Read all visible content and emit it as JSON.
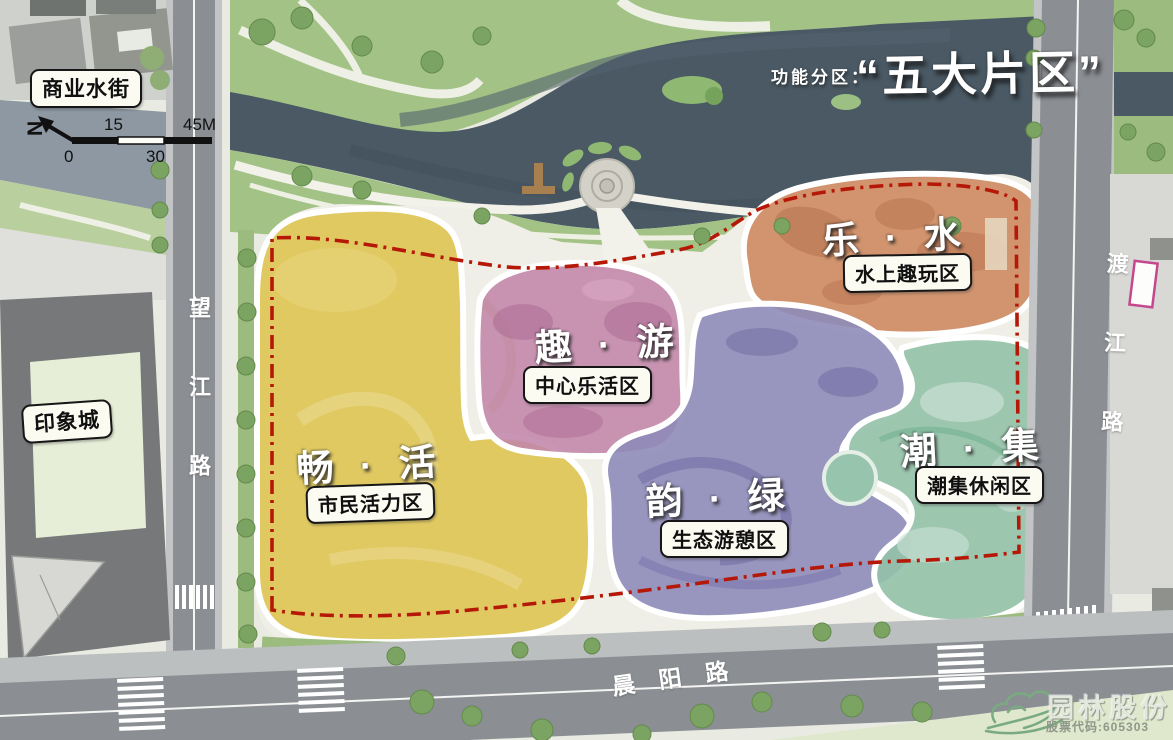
{
  "title": {
    "prefix": "功能分区：",
    "main": "“五大片区”"
  },
  "north": {
    "label": "N"
  },
  "scale_bar": {
    "tick_0": "0",
    "tick_15": "15",
    "tick_30": "30",
    "tick_45": "45M"
  },
  "zones": [
    {
      "name": "畅 · 活",
      "subtitle": "市民活力区",
      "color": "#ddc44e"
    },
    {
      "name": "趣 · 游",
      "subtitle": "中心乐活区",
      "color": "#c286aa"
    },
    {
      "name": "乐 · 水",
      "subtitle": "水上趣玩区",
      "color": "#cd8a62"
    },
    {
      "name": "韵 · 绿",
      "subtitle": "生态游憩区",
      "color": "#8e8bb9"
    },
    {
      "name": "潮 · 集",
      "subtitle": "潮集休闲区",
      "color": "#93c1a9"
    }
  ],
  "landmarks": {
    "water_street": "商业水街",
    "yinxiangcheng": "印象城"
  },
  "roads": {
    "west": "望江路",
    "east": "渡江路",
    "south": "晨阳路"
  },
  "logo": {
    "company": "园林股份",
    "stock_code": "股票代码:605303"
  },
  "colors": {
    "boundary": "#b51807",
    "water": "#4a5964",
    "park_green": "#a3c386",
    "road": "#8b8f94"
  }
}
